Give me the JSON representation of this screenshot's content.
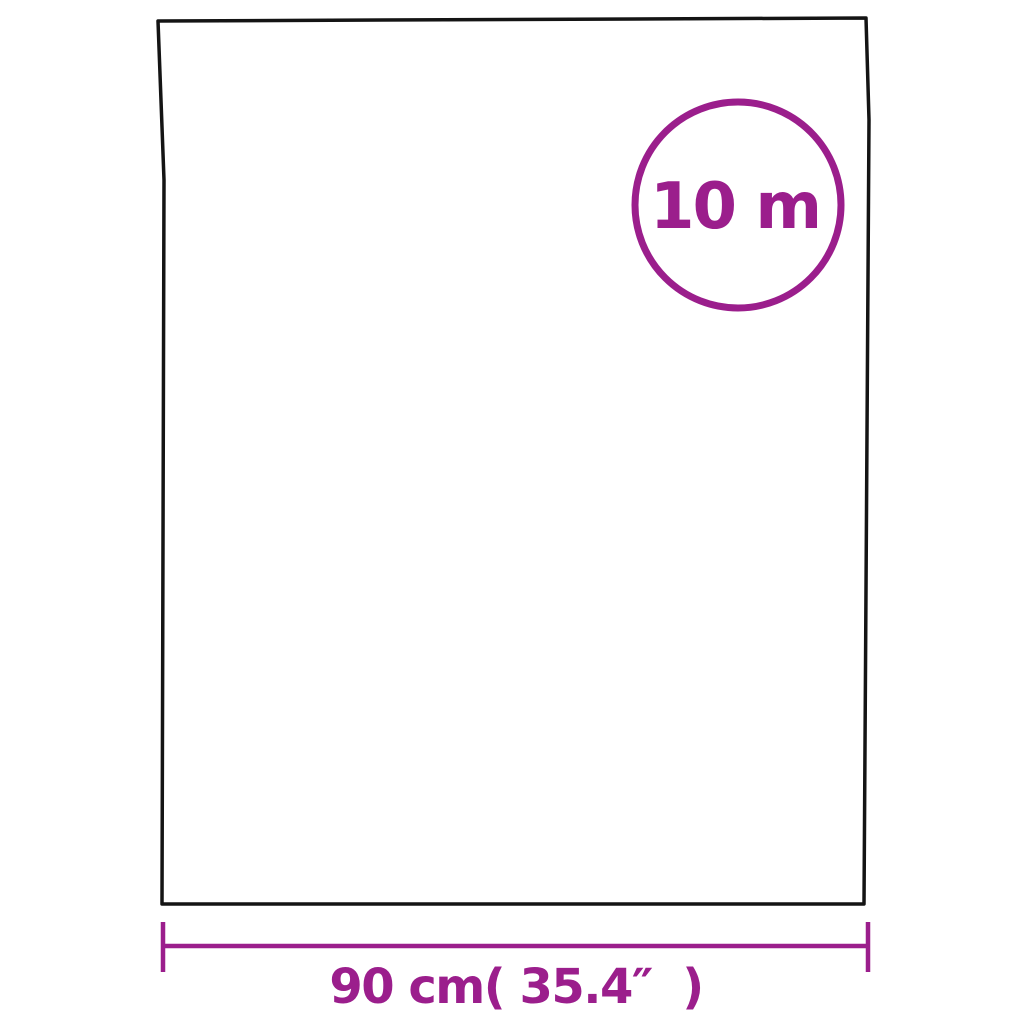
{
  "image": {
    "description": "Product dimension diagram of a rectangular film sheet / roll",
    "background": "#ffffff"
  },
  "colors": {
    "outline": "#141414",
    "accent": "#9b1e8c",
    "badge_fill": "#ffffff"
  },
  "diagram": {
    "roll_length_label": "10 m",
    "width_label": "90 cm( 35.4″  )"
  }
}
